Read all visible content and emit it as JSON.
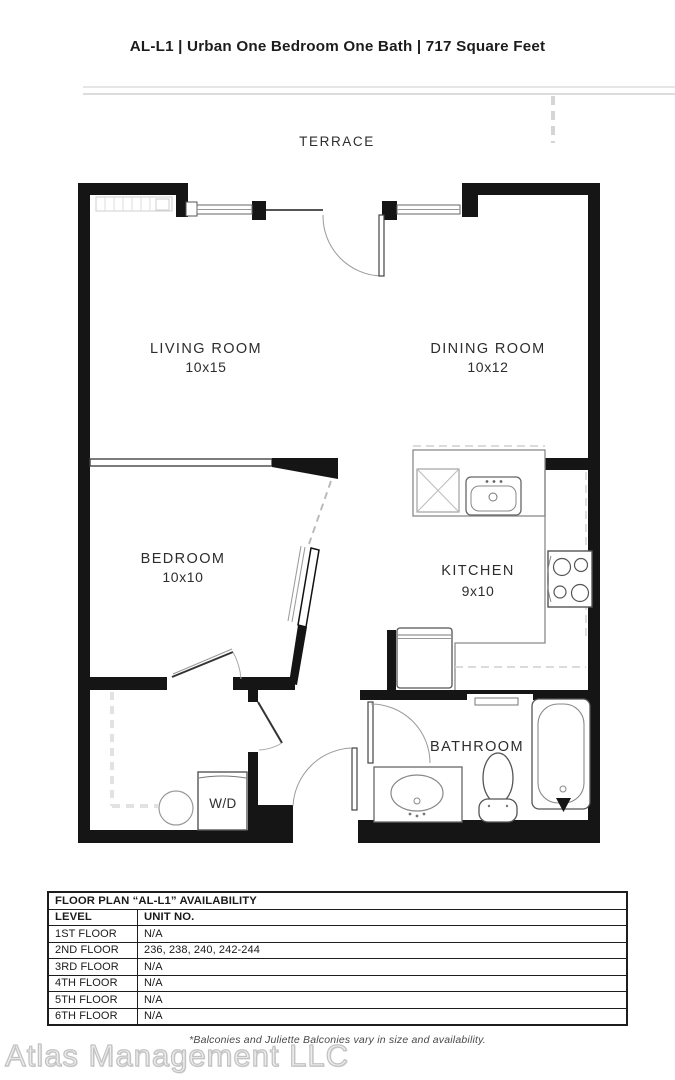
{
  "title": "AL-L1 | Urban One Bedroom One Bath | 717 Square Feet",
  "plan": {
    "terrace_label": "TERRACE",
    "rooms": [
      {
        "name": "LIVING ROOM",
        "dims": "10x15"
      },
      {
        "name": "DINING ROOM",
        "dims": "10x12"
      },
      {
        "name": "BEDROOM",
        "dims": "10x10"
      },
      {
        "name": "KITCHEN",
        "dims": "9x10"
      },
      {
        "name": "BATHROOM"
      }
    ],
    "wd_label": "W/D"
  },
  "availability_table": {
    "title": "FLOOR PLAN “AL-L1” AVAILABILITY",
    "columns": [
      "LEVEL",
      "UNIT NO."
    ],
    "rows": [
      {
        "level": "1ST FLOOR",
        "units": "N/A"
      },
      {
        "level": "2ND FLOOR",
        "units": "236, 238, 240, 242-244"
      },
      {
        "level": "3RD FLOOR",
        "units": "N/A"
      },
      {
        "level": "4TH FLOOR",
        "units": "N/A"
      },
      {
        "level": "5TH FLOOR",
        "units": "N/A"
      },
      {
        "level": "6TH FLOOR",
        "units": "N/A"
      }
    ]
  },
  "footnote": "*Balconies and Juliette Balconies vary in size and availability.",
  "watermark": "Atlas Management LLC",
  "colors": {
    "wall": "#151515",
    "line": "#8a8a8a",
    "light_line": "#e3e3e3",
    "text": "#2d2d2d",
    "watermark": "#d2d2d2"
  }
}
